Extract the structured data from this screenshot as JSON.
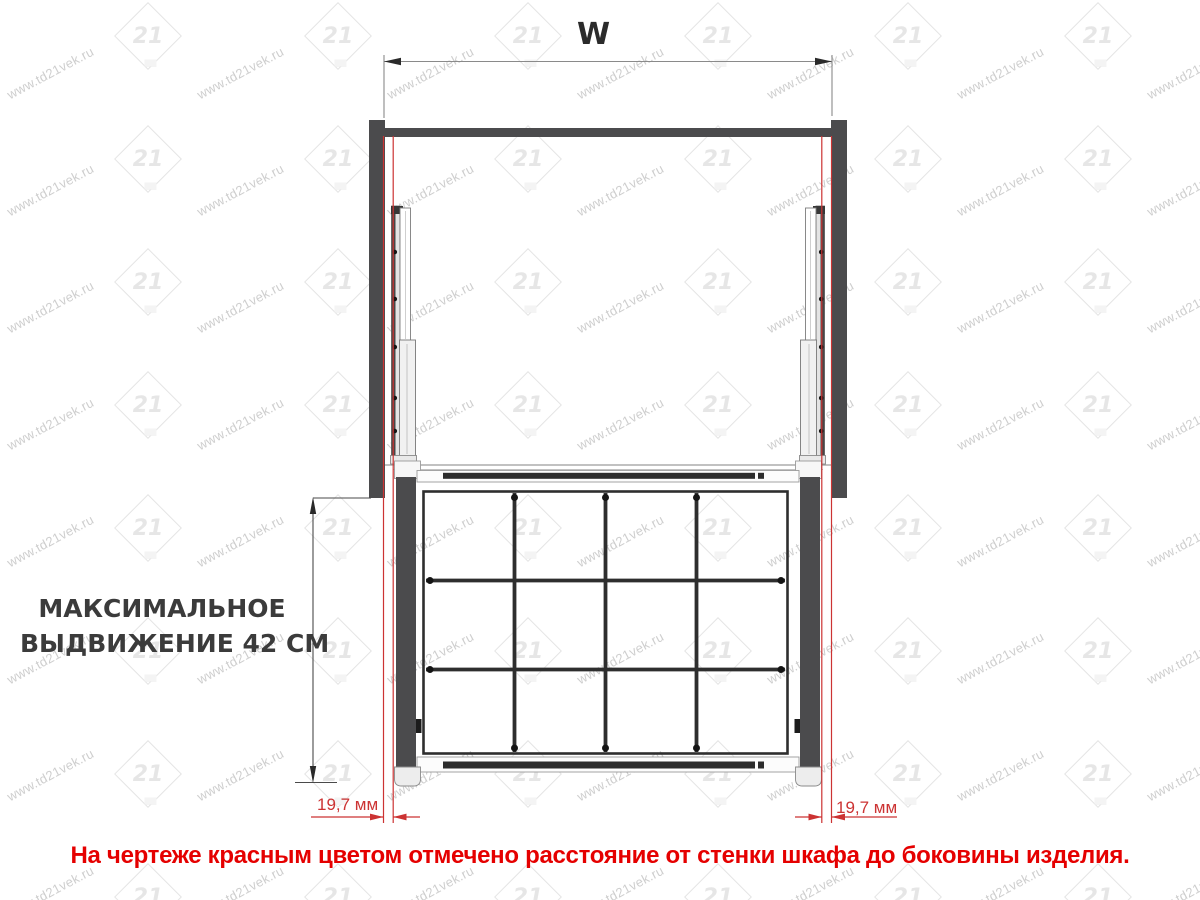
{
  "diagram": {
    "width_dim_label": "W",
    "max_extension_label_line1": "МАКСИМАЛЬНОЕ",
    "max_extension_label_line2": "ВЫДВИЖЕНИЕ 42 СМ",
    "left_gap_dim_label": "19,7 мм",
    "right_gap_dim_label": "19,7 мм"
  },
  "note": {
    "text": "На чертеже красным цветом отмечено расстояние  от стенки шкафа до боковины изделия."
  },
  "watermark": {
    "text": "www.td21vek.ru",
    "logo_text": "21"
  },
  "colors": {
    "red_accent": "#cc3333",
    "note_red": "#e50000",
    "wall_gray": "#4b4b4d",
    "wire_dark": "#2e2e2e",
    "watermark_gray": "#c6c6c6"
  }
}
